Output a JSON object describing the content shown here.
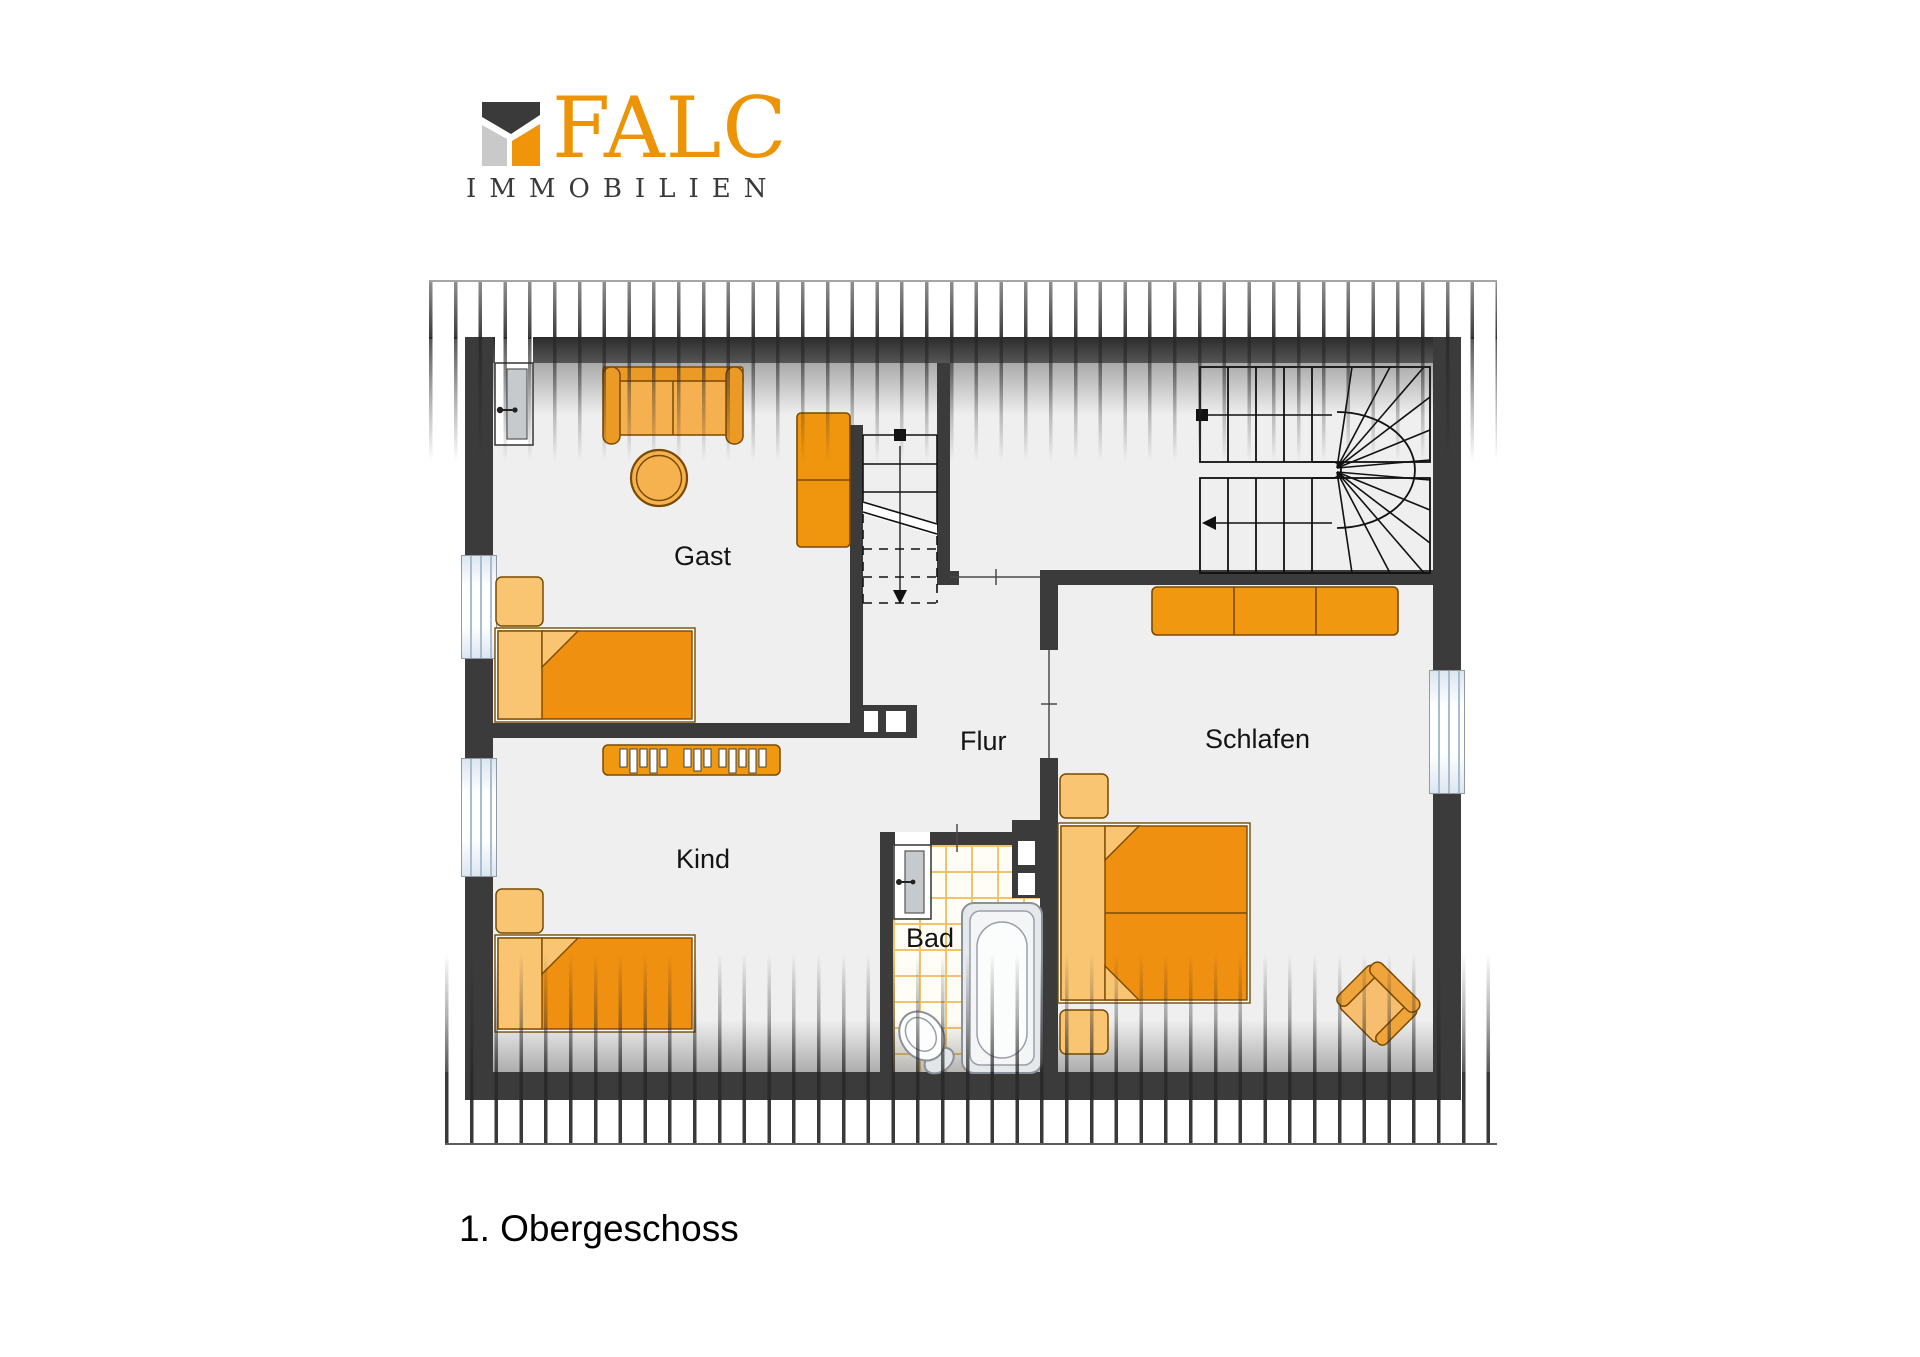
{
  "logo": {
    "brand": "FALC",
    "subtitle": "IMMOBILIEN",
    "brand_color": "#EC9306",
    "subtitle_color": "#3A3A3A",
    "mark": {
      "roof_color": "#3A3A3A",
      "left_wall_color": "#C9C9C9",
      "right_wall_color": "#F0940A"
    }
  },
  "plan": {
    "rooms": {
      "gast": {
        "label": "Gast"
      },
      "flur": {
        "label": "Flur"
      },
      "schlafen": {
        "label": "Schlafen"
      },
      "kind": {
        "label": "Kind"
      },
      "bad": {
        "label": "Bad"
      }
    },
    "features": [
      "main-staircase-with-winders",
      "small-staircase-to-attic",
      "roof-slope-hatching-top",
      "roof-slope-hatching-bottom"
    ],
    "fixtures": [
      "bathtub",
      "toilet",
      "door-gast",
      "door-bad",
      "window-left-upper",
      "window-left-lower",
      "window-right"
    ],
    "furniture": [
      "sofa",
      "round-table",
      "cabinet",
      "bed-gast",
      "nightstand-gast",
      "desk-kind",
      "bed-kind",
      "nightstand-kind",
      "wardrobe-schlafen",
      "double-bed-schlafen",
      "nightstand-schlafen-1",
      "nightstand-schlafen-2",
      "armchair-schlafen"
    ]
  },
  "caption": "1. Obergeschoss",
  "colors": {
    "wall": "#3B3B3B",
    "floor": "#EFEFEF",
    "furniture_orange": "#F09A16",
    "furniture_light": "#F9C573",
    "outline_brown": "#7A4A00",
    "window_blue": "#A9BDD1",
    "tile_line": "#F2C36B",
    "text": "#141414"
  }
}
